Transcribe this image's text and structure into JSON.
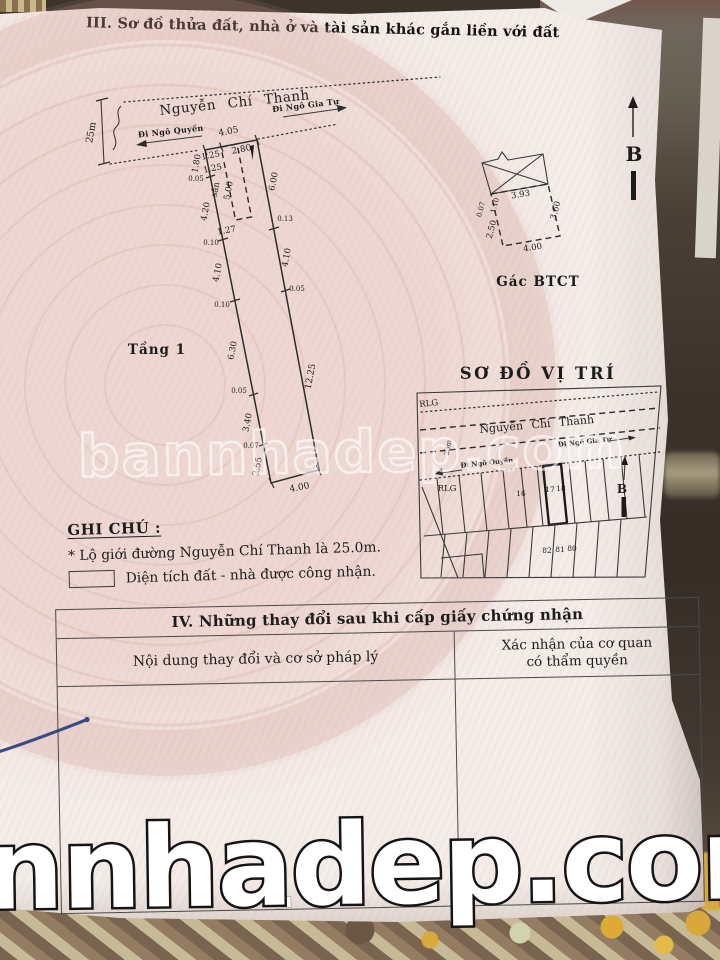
{
  "document": {
    "section3_title": "III. Sơ đồ thửa đất, nhà ở và tài sản khác gắn liền với đất"
  },
  "plot": {
    "street_name": "Nguyễn Chí Thanh",
    "dir_right": "Đi Ngô Gia Tự",
    "dir_left": "Đi Ngô Quyền",
    "road_width": "25m",
    "floor_label": "Tầng 1",
    "dim_top": "4.05",
    "dim_top_left": "1.25",
    "dim_top_right": "2.80",
    "yard_label": "sân",
    "yard_width": "1.25",
    "yard_length": "5.00",
    "yard_bottom": "1.27",
    "left_dims": [
      "1.80",
      "0.05",
      "4.20",
      "0.10",
      "4.10",
      "0.10",
      "6.30",
      "0.05",
      "3.40",
      "0.07",
      "2.55"
    ],
    "right_dims": [
      "6.00",
      "0.13",
      "4.10",
      "0.05",
      "12.25"
    ],
    "dim_bottom": "4.00"
  },
  "mezzanine": {
    "caption": "Gác BTCT",
    "dim_top": "3.93",
    "dim_left_upper": "1.10",
    "dim_left_tiny": "0.07",
    "dim_left": "2.50",
    "dim_right": "3.60",
    "dim_bottom": "4.00"
  },
  "compass": {
    "north_label": "B"
  },
  "location_map": {
    "title": "SƠ ĐỒ VỊ TRÍ",
    "rlg_top": "RLG",
    "rlg_bottom": "RLG",
    "street_name": "Nguyễn Chí Thanh",
    "dir_right": "Đi Ngô Gia Tự",
    "dir_left": "Đi Ngô Quyền",
    "road_width": "25m",
    "north_label": "B",
    "parcels_top": [
      "16",
      "17",
      "18"
    ],
    "parcels_bottom": [
      "82",
      "81",
      "80"
    ]
  },
  "notes": {
    "heading": "GHI CHÚ :",
    "line1": "*  Lộ giới đường Nguyễn Chí Thanh là 25.0m.",
    "line2": "Diện tích đất - nhà được công nhận."
  },
  "section4": {
    "title": "IV. Những thay đổi sau khi cấp giấy chứng nhận",
    "col1_header": "Nội dung thay đổi và cơ sở pháp lý",
    "col2_header_line1": "Xác nhận của cơ quan",
    "col2_header_line2": "có thẩm quyền"
  },
  "watermarks": {
    "middle": "bannhadep.com",
    "bottom": "nnhadep.com"
  },
  "colors": {
    "paper": "#f4ece9",
    "emblem_pink": "#d9a196",
    "pen_blue": "#3a4a85",
    "watermark_white": "#ffffff"
  }
}
